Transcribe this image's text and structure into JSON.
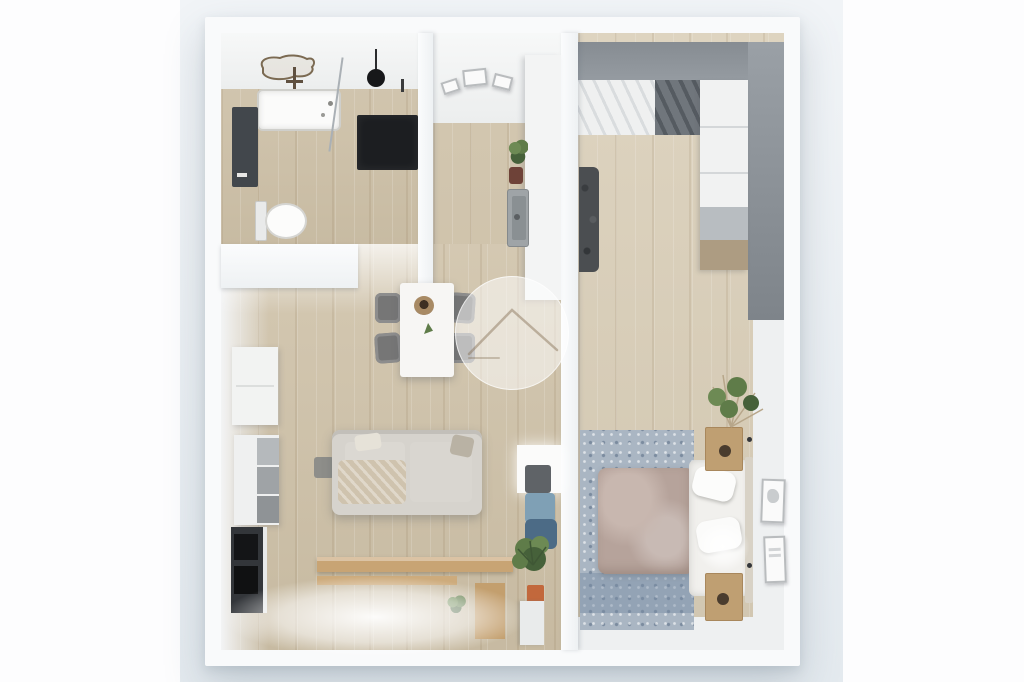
{
  "app": {
    "name": "3d-floor-plan-render",
    "description": "Top-down 3D render of a one-bedroom apartment: bathroom, hallway kitchen, living-dining room and bedroom, with a translucent circular house-logo watermark in the center."
  },
  "watermark": {
    "label": "Translucent circular watermark with house roof outline"
  },
  "rooms": [
    {
      "id": "bathroom",
      "label": "Bathroom with bathtub, dark walk-in shower, toilet, towel radiator and ceiling lamp"
    },
    {
      "id": "hallway-kitchen",
      "label": "Hallway and kitchen strip with white counter, sink, plant and leaning picture frames"
    },
    {
      "id": "living-room",
      "label": "Living room with dining table, four gray chairs, light sofa, TV cabinet, shelving, wooden desk, blue armchair and potted plants"
    },
    {
      "id": "bedroom",
      "label": "Bedroom with double bed on patterned blue rug, wardrobe wall, two nightstands, bedside lamp, plant and wall frames"
    }
  ],
  "furniture": {
    "bathtub": "Bathtub",
    "shower": "Walk-in shower",
    "toilet": "Toilet",
    "radiator": "Towel radiator",
    "counter": "Kitchen counter",
    "sink": "Kitchen sink",
    "dining_table": "Dining table",
    "dining_chair": "Dining chair",
    "sofa": "Sofa with blanket and pillows",
    "tv_unit": "TV cabinet",
    "shelf_unit": "Shelving unit",
    "cabinet": "Storage cabinet",
    "desk": "Wooden desk",
    "window_light": "Window light",
    "armchair": "Blue armchair",
    "floor_lamp": "Floor lamp",
    "plant": "Potted plant",
    "bed": "Double bed",
    "rug": "Patterned area rug",
    "wardrobe": "Wardrobe with sliding doors",
    "accent_wall": "Gray accent wall",
    "nightstand": "Nightstand",
    "bedside_lamp": "Glowing bedside lamp",
    "wall_frames": "Wall picture frames",
    "hanging_clothes": "Hanging clothes"
  },
  "colors": {
    "margin_white": "#fdfdfe",
    "render_bg_top": "#f1f4f7",
    "render_bg_bottom": "#e4eaef",
    "wall": "#f9fafb",
    "wall_shade": "#d9dee3",
    "white_wall_face": "#f2f3f4",
    "floor_wood": "#cfc2a9",
    "floor_wood_light": "#dacfb9",
    "accent_gray": "#8e949a",
    "accent_gray_dark": "#7c8288",
    "shower_black": "#1c1e21",
    "radiator_dark": "#42474c",
    "rug_blue": "#aab6c3",
    "rug_blue_dark": "#91a1b3",
    "duvet_mauve": "#b6a39b",
    "duvet_light": "#c8b7af",
    "bed_white": "#f1f0ed",
    "night_wood": "#bf9f72",
    "sofa_base": "#d6d3cd",
    "sofa_shadow": "#c2bfb9",
    "blanket_beige": "#cfc3ae",
    "chair_gray": "#767676",
    "table_white": "#f7f6f4",
    "counter_white": "#f3f4f4",
    "sink_gray": "#9fa4a7",
    "tv_black": "#33363a",
    "screen_black": "#141517",
    "desk_wood": "#c8a474",
    "leaf_green": "#5f7c49",
    "leaf_green_dark": "#46613a",
    "pot_orange": "#c2683c",
    "armchair_blue": "#4c6b86",
    "armchair_blue_light": "#7fa0b5",
    "watermark_line": "rgba(130,108,82,0.45)"
  }
}
